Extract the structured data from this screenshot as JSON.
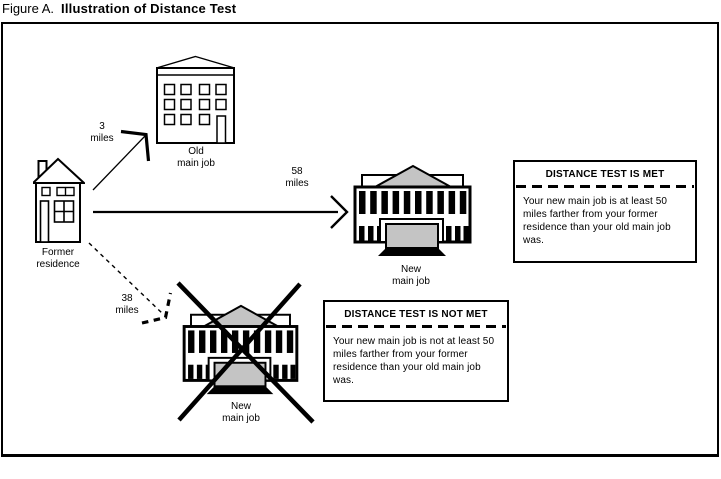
{
  "figure": {
    "label": "Figure A.",
    "title": "Illustration of Distance Test"
  },
  "nodes": {
    "former_residence": {
      "label": "Former\nresidence"
    },
    "old_main_job": {
      "label": "Old\nmain job"
    },
    "new_main_job_met": {
      "label": "New\nmain job"
    },
    "new_main_job_not_met": {
      "label": "New\nmain job"
    }
  },
  "distances": {
    "to_old_job": "3\nmiles",
    "to_new_job_met": "58\nmiles",
    "to_new_job_not_met": "38\nmiles"
  },
  "callouts": {
    "met": {
      "heading": "DISTANCE TEST IS MET",
      "body": "Your new main job is at least 50 miles farther from your former residence than your old main job was."
    },
    "not_met": {
      "heading": "DISTANCE TEST IS NOT MET",
      "body": "Your new main job is not at least 50 miles farther from your former residence than your old main job was."
    }
  },
  "colors": {
    "ink": "#000000",
    "paper": "#ffffff",
    "shade": "#c4c4c4"
  }
}
